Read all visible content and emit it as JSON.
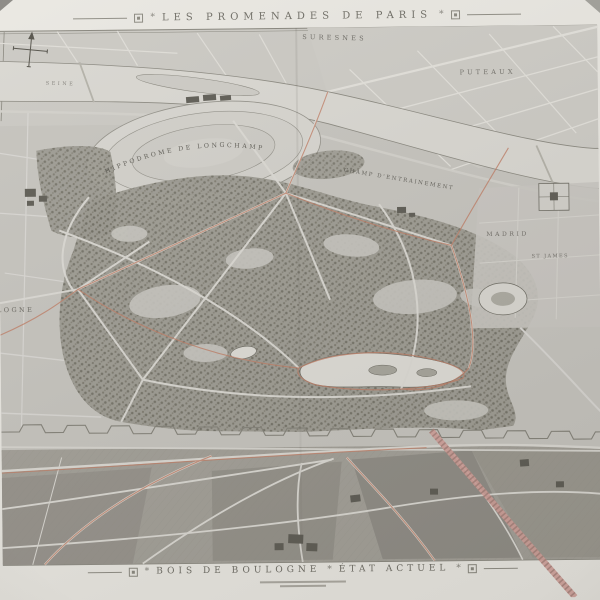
{
  "titles": {
    "top": "LES PROMENADES DE PARIS",
    "bottom_name": "BOIS DE BOULOGNE",
    "bottom_state": "ÉTAT ACTUEL",
    "separator": "*"
  },
  "map_labels": {
    "suresnes": "SURESNES",
    "puteaux": "PUTEAUX",
    "seine": "SEINE",
    "hippodrome": "HIPPODROME DE LONGCHAMP",
    "champ_entrainement": "CHAMP D'ENTRAINEMENT",
    "madrid": "MADRID",
    "st_james": "ST JAMES",
    "boulogne": "BOULOGNE"
  },
  "colors": {
    "paper": "#e9e7e1",
    "ground": "#c6c4be",
    "woods_stipple": "#8a877c",
    "river": "#d9d7d1",
    "fields": "#a3a098",
    "promenade_route_red": "#c07f67",
    "railway_pink": "#d0a099",
    "ink": "#55534b"
  }
}
